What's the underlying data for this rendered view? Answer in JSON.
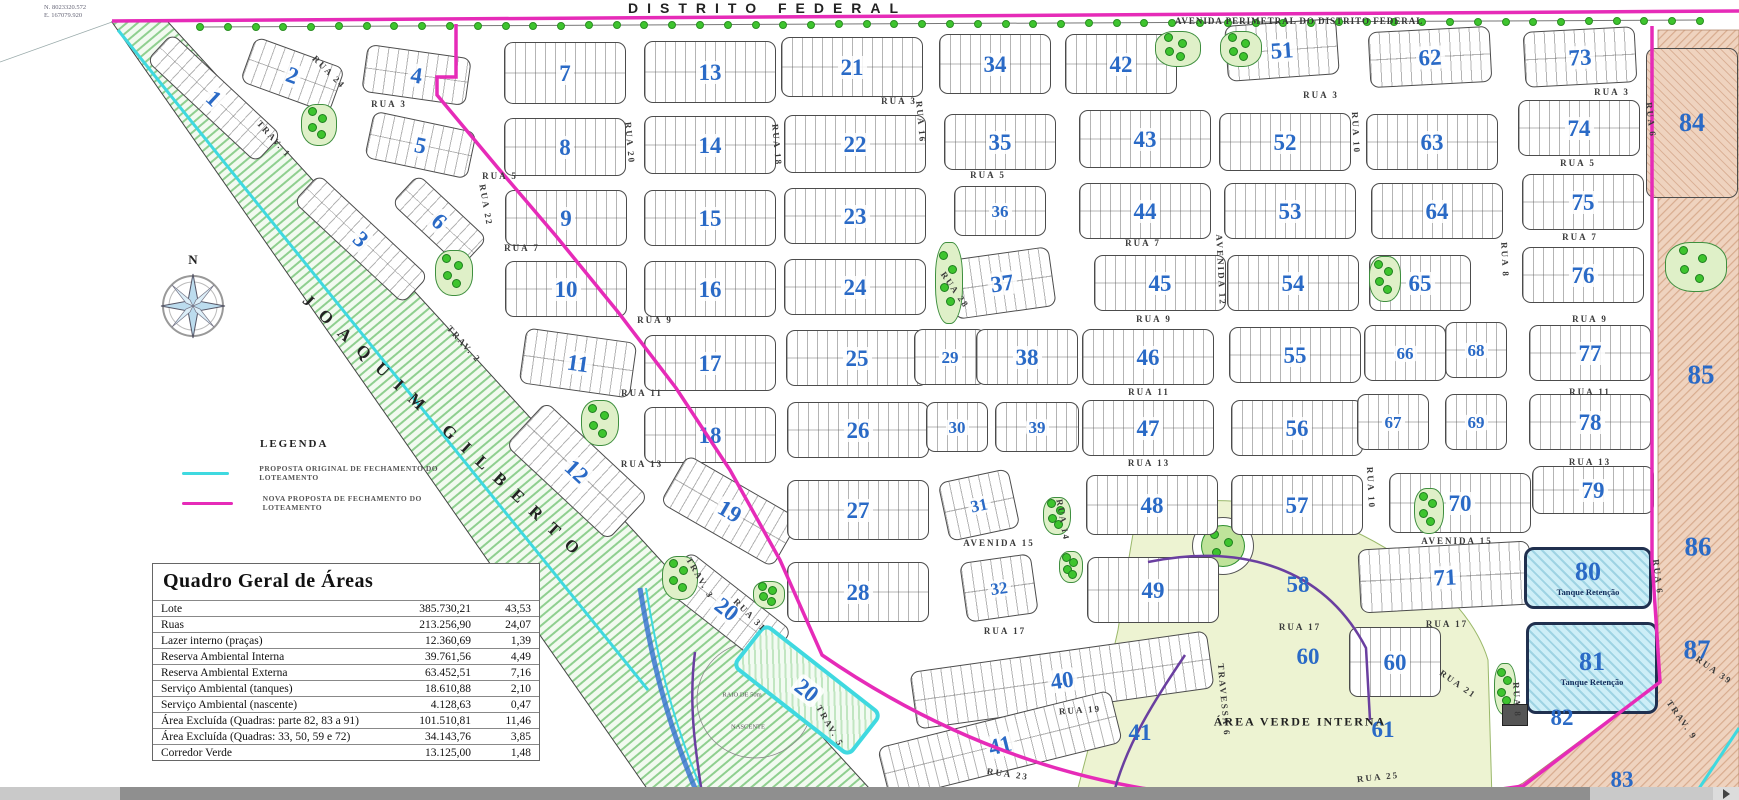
{
  "header": {
    "top_title": "DISTRITO FEDERAL",
    "avenida_perimetral": "AVENIDA PERIMETRAL DO DISTRITO FEDERAL",
    "diagonal_road": "JOAQUIM GILBERTO",
    "corner_coordinates": {
      "north": "N. 8023320.572",
      "east": "E. 167079.920"
    },
    "compass_label": "N"
  },
  "legend": {
    "title": "LEGENDA",
    "items": [
      {
        "color": "#3fd9e0",
        "label": "PROPOSTA ORIGINAL DE FECHAMENTO DO LOTEAMENTO"
      },
      {
        "color": "#e62bb8",
        "label": "NOVA PROPOSTA DE FECHAMENTO DO LOTEAMENTO"
      }
    ]
  },
  "areas_table": {
    "title": "Quadro Geral de Áreas",
    "rows": [
      {
        "label": "Lote",
        "area": "385.730,21",
        "pct": "43,53"
      },
      {
        "label": "Ruas",
        "area": "213.256,90",
        "pct": "24,07"
      },
      {
        "label": "Lazer interno (praças)",
        "area": "12.360,69",
        "pct": "1,39"
      },
      {
        "label": "Reserva Ambiental Interna",
        "area": "39.761,56",
        "pct": "4,49"
      },
      {
        "label": "Reserva Ambiental Externa",
        "area": "63.452,51",
        "pct": "7,16"
      },
      {
        "label": "Serviço Ambiental (tanques)",
        "area": "18.610,88",
        "pct": "2,10"
      },
      {
        "label": "Serviço Ambiental (nascente)",
        "area": "4.128,63",
        "pct": "0,47"
      },
      {
        "label": "Área Excluída (Quadras: parte 82, 83 a 91)",
        "area": "101.510,81",
        "pct": "11,46"
      },
      {
        "label": "Área Excluída (Quadras: 33, 50, 59 e 72)",
        "area": "34.143,76",
        "pct": "3,85"
      },
      {
        "label": "Corredor Verde",
        "area": "13.125,00",
        "pct": "1,48"
      }
    ]
  },
  "colors": {
    "original_proposal": "#3fd9e0",
    "new_proposal": "#e62bb8",
    "block_number_blue": "#2a6ac6",
    "tree_green": "#3ec42e",
    "excluded_pink": "#efd3bf",
    "tank_blue": "#cdeef7",
    "green_area": "#edf3d2",
    "corridor_purple": "#6a3fa0"
  },
  "map": {
    "tank_sublabel": "Tanque Retenção",
    "blocks": [
      {
        "n": "1",
        "x": 214,
        "y": 98,
        "w": 150,
        "h": 38,
        "rot": 43
      },
      {
        "n": "2",
        "x": 292,
        "y": 75,
        "w": 95,
        "h": 48,
        "rot": 20
      },
      {
        "n": "3",
        "x": 361,
        "y": 239,
        "w": 150,
        "h": 38,
        "rot": 43
      },
      {
        "n": "4",
        "x": 416,
        "y": 75,
        "w": 105,
        "h": 48,
        "rot": 8
      },
      {
        "n": "5",
        "x": 420,
        "y": 145,
        "w": 105,
        "h": 48,
        "rot": 12
      },
      {
        "n": "6",
        "x": 439,
        "y": 221,
        "w": 95,
        "h": 40,
        "rot": 43
      },
      {
        "n": "7",
        "x": 565,
        "y": 73,
        "w": 122,
        "h": 62,
        "rot": 0
      },
      {
        "n": "8",
        "x": 565,
        "y": 147,
        "w": 122,
        "h": 58,
        "rot": 0
      },
      {
        "n": "9",
        "x": 566,
        "y": 218,
        "w": 122,
        "h": 56,
        "rot": 0
      },
      {
        "n": "10",
        "x": 566,
        "y": 289,
        "w": 122,
        "h": 56,
        "rot": 0
      },
      {
        "n": "11",
        "x": 578,
        "y": 363,
        "w": 112,
        "h": 56,
        "rot": 8
      },
      {
        "n": "12",
        "x": 577,
        "y": 471,
        "w": 140,
        "h": 60,
        "rot": 43
      },
      {
        "n": "13",
        "x": 710,
        "y": 72,
        "w": 132,
        "h": 62,
        "rot": 0
      },
      {
        "n": "14",
        "x": 710,
        "y": 145,
        "w": 132,
        "h": 58,
        "rot": 0
      },
      {
        "n": "15",
        "x": 710,
        "y": 218,
        "w": 132,
        "h": 56,
        "rot": 0
      },
      {
        "n": "16",
        "x": 710,
        "y": 289,
        "w": 132,
        "h": 56,
        "rot": 0
      },
      {
        "n": "17",
        "x": 710,
        "y": 363,
        "w": 132,
        "h": 56,
        "rot": 0
      },
      {
        "n": "18",
        "x": 710,
        "y": 435,
        "w": 132,
        "h": 56,
        "rot": 0
      },
      {
        "n": "19",
        "x": 730,
        "y": 511,
        "w": 130,
        "h": 56,
        "rot": 30
      },
      {
        "n": "20",
        "x": 727,
        "y": 609,
        "w": 130,
        "h": 46,
        "rot": 38
      },
      {
        "n": "20",
        "x": 807,
        "y": 690,
        "w": 150,
        "h": 56,
        "rot": 38,
        "cls": "cyan"
      },
      {
        "n": "21",
        "x": 852,
        "y": 67,
        "w": 142,
        "h": 60,
        "rot": 0
      },
      {
        "n": "22",
        "x": 855,
        "y": 144,
        "w": 142,
        "h": 58,
        "rot": 0
      },
      {
        "n": "23",
        "x": 855,
        "y": 216,
        "w": 142,
        "h": 56,
        "rot": 0
      },
      {
        "n": "24",
        "x": 855,
        "y": 287,
        "w": 142,
        "h": 56,
        "rot": 0
      },
      {
        "n": "25",
        "x": 857,
        "y": 358,
        "w": 142,
        "h": 56,
        "rot": 0
      },
      {
        "n": "26",
        "x": 858,
        "y": 430,
        "w": 142,
        "h": 56,
        "rot": 0
      },
      {
        "n": "27",
        "x": 858,
        "y": 510,
        "w": 142,
        "h": 60,
        "rot": 0
      },
      {
        "n": "28",
        "x": 858,
        "y": 592,
        "w": 142,
        "h": 60,
        "rot": 0
      },
      {
        "n": "29",
        "x": 950,
        "y": 357,
        "w": 72,
        "h": 56,
        "rot": 0,
        "cls": "sm"
      },
      {
        "n": "30",
        "x": 957,
        "y": 427,
        "w": 62,
        "h": 50,
        "rot": 0,
        "cls": "sm"
      },
      {
        "n": "31",
        "x": 979,
        "y": 505,
        "w": 72,
        "h": 60,
        "rot": -12,
        "cls": "sm"
      },
      {
        "n": "32",
        "x": 999,
        "y": 588,
        "w": 72,
        "h": 60,
        "rot": -8,
        "cls": "sm"
      },
      {
        "n": "34",
        "x": 995,
        "y": 64,
        "w": 112,
        "h": 60,
        "rot": 0
      },
      {
        "n": "35",
        "x": 1000,
        "y": 142,
        "w": 112,
        "h": 56,
        "rot": 0
      },
      {
        "n": "36",
        "x": 1000,
        "y": 211,
        "w": 92,
        "h": 50,
        "rot": 0,
        "cls": "sm"
      },
      {
        "n": "37",
        "x": 1002,
        "y": 283,
        "w": 102,
        "h": 60,
        "rot": -8
      },
      {
        "n": "38",
        "x": 1027,
        "y": 357,
        "w": 102,
        "h": 56,
        "rot": 0
      },
      {
        "n": "39",
        "x": 1037,
        "y": 427,
        "w": 84,
        "h": 50,
        "rot": 0,
        "cls": "sm"
      },
      {
        "n": "40",
        "x": 1062,
        "y": 680,
        "w": 300,
        "h": 58,
        "rot": -8
      },
      {
        "n": "41",
        "x": 1000,
        "y": 745,
        "w": 240,
        "h": 54,
        "rot": -14
      },
      {
        "n": "42",
        "x": 1121,
        "y": 64,
        "w": 112,
        "h": 60,
        "rot": 0
      },
      {
        "n": "43",
        "x": 1145,
        "y": 139,
        "w": 132,
        "h": 58,
        "rot": 0
      },
      {
        "n": "44",
        "x": 1145,
        "y": 211,
        "w": 132,
        "h": 56,
        "rot": 0
      },
      {
        "n": "45",
        "x": 1160,
        "y": 283,
        "w": 132,
        "h": 56,
        "rot": 0
      },
      {
        "n": "46",
        "x": 1148,
        "y": 357,
        "w": 132,
        "h": 56,
        "rot": 0
      },
      {
        "n": "47",
        "x": 1148,
        "y": 428,
        "w": 132,
        "h": 56,
        "rot": 0
      },
      {
        "n": "48",
        "x": 1152,
        "y": 505,
        "w": 132,
        "h": 60,
        "rot": 0
      },
      {
        "n": "49",
        "x": 1153,
        "y": 590,
        "w": 132,
        "h": 66,
        "rot": 0
      },
      {
        "n": "51",
        "x": 1282,
        "y": 50,
        "w": 112,
        "h": 56,
        "rot": -4
      },
      {
        "n": "52",
        "x": 1285,
        "y": 142,
        "w": 132,
        "h": 58,
        "rot": 0
      },
      {
        "n": "53",
        "x": 1290,
        "y": 211,
        "w": 132,
        "h": 56,
        "rot": 0
      },
      {
        "n": "54",
        "x": 1293,
        "y": 283,
        "w": 132,
        "h": 56,
        "rot": 0
      },
      {
        "n": "55",
        "x": 1295,
        "y": 355,
        "w": 132,
        "h": 56,
        "rot": 0
      },
      {
        "n": "56",
        "x": 1297,
        "y": 428,
        "w": 132,
        "h": 56,
        "rot": 0
      },
      {
        "n": "57",
        "x": 1297,
        "y": 505,
        "w": 132,
        "h": 60,
        "rot": 0
      },
      {
        "n": "60",
        "x": 1395,
        "y": 662,
        "w": 92,
        "h": 70,
        "rot": 0
      },
      {
        "n": "62",
        "x": 1430,
        "y": 57,
        "w": 122,
        "h": 56,
        "rot": -3
      },
      {
        "n": "63",
        "x": 1432,
        "y": 142,
        "w": 132,
        "h": 56,
        "rot": 0
      },
      {
        "n": "64",
        "x": 1437,
        "y": 211,
        "w": 132,
        "h": 56,
        "rot": 0
      },
      {
        "n": "65",
        "x": 1420,
        "y": 283,
        "w": 102,
        "h": 56,
        "rot": 0
      },
      {
        "n": "66",
        "x": 1405,
        "y": 353,
        "w": 82,
        "h": 56,
        "rot": 0,
        "cls": "sm"
      },
      {
        "n": "67",
        "x": 1393,
        "y": 422,
        "w": 72,
        "h": 56,
        "rot": 0,
        "cls": "sm"
      },
      {
        "n": "68",
        "x": 1476,
        "y": 350,
        "w": 62,
        "h": 56,
        "rot": 0,
        "cls": "sm"
      },
      {
        "n": "69",
        "x": 1476,
        "y": 422,
        "w": 62,
        "h": 56,
        "rot": 0,
        "cls": "sm"
      },
      {
        "n": "70",
        "x": 1460,
        "y": 503,
        "w": 142,
        "h": 60,
        "rot": 0
      },
      {
        "n": "71",
        "x": 1445,
        "y": 577,
        "w": 172,
        "h": 64,
        "rot": -3
      },
      {
        "n": "73",
        "x": 1580,
        "y": 57,
        "w": 112,
        "h": 56,
        "rot": -3
      },
      {
        "n": "74",
        "x": 1579,
        "y": 128,
        "w": 122,
        "h": 56,
        "rot": 0
      },
      {
        "n": "75",
        "x": 1583,
        "y": 202,
        "w": 122,
        "h": 56,
        "rot": 0
      },
      {
        "n": "76",
        "x": 1583,
        "y": 275,
        "w": 122,
        "h": 56,
        "rot": 0
      },
      {
        "n": "77",
        "x": 1590,
        "y": 353,
        "w": 122,
        "h": 56,
        "rot": 0
      },
      {
        "n": "78",
        "x": 1590,
        "y": 422,
        "w": 122,
        "h": 56,
        "rot": 0
      },
      {
        "n": "79",
        "x": 1593,
        "y": 490,
        "w": 122,
        "h": 48,
        "rot": 0
      },
      {
        "n": "84",
        "x": 1692,
        "y": 123,
        "w": 92,
        "h": 150,
        "rot": 0,
        "cls": "pink"
      },
      {
        "n": "80",
        "x": 1588,
        "y": 578,
        "w": 128,
        "h": 62,
        "rot": 0,
        "cls": "tank",
        "sub": "Tanque Retenção"
      },
      {
        "n": "81",
        "x": 1592,
        "y": 668,
        "w": 132,
        "h": 92,
        "rot": 0,
        "cls": "tank",
        "sub": "Tanque Retenção"
      }
    ],
    "streets": [
      {
        "t": "RUA 3",
        "x": 389,
        "y": 104,
        "r": 0
      },
      {
        "t": "RUA 3",
        "x": 899,
        "y": 101,
        "r": 0
      },
      {
        "t": "RUA 3",
        "x": 1321,
        "y": 95,
        "r": 0
      },
      {
        "t": "RUA 3",
        "x": 1612,
        "y": 92,
        "r": 0
      },
      {
        "t": "RUA 5",
        "x": 500,
        "y": 176,
        "r": 0
      },
      {
        "t": "RUA 5",
        "x": 988,
        "y": 175,
        "r": 0
      },
      {
        "t": "RUA 5",
        "x": 1578,
        "y": 163,
        "r": 0
      },
      {
        "t": "RUA 7",
        "x": 522,
        "y": 248,
        "r": 0
      },
      {
        "t": "RUA 7",
        "x": 1143,
        "y": 243,
        "r": 0
      },
      {
        "t": "RUA 7",
        "x": 1580,
        "y": 237,
        "r": 0
      },
      {
        "t": "RUA 9",
        "x": 655,
        "y": 320,
        "r": 0
      },
      {
        "t": "RUA 9",
        "x": 1154,
        "y": 319,
        "r": 0
      },
      {
        "t": "RUA 9",
        "x": 1590,
        "y": 319,
        "r": 0
      },
      {
        "t": "RUA 11",
        "x": 642,
        "y": 393,
        "r": 0
      },
      {
        "t": "RUA 11",
        "x": 1149,
        "y": 392,
        "r": 0
      },
      {
        "t": "RUA 11",
        "x": 1590,
        "y": 392,
        "r": 0
      },
      {
        "t": "RUA 13",
        "x": 642,
        "y": 464,
        "r": 0
      },
      {
        "t": "RUA 13",
        "x": 1149,
        "y": 463,
        "r": 0
      },
      {
        "t": "RUA 13",
        "x": 1590,
        "y": 462,
        "r": 0
      },
      {
        "t": "AVENIDA 15",
        "x": 999,
        "y": 543,
        "r": 0
      },
      {
        "t": "AVENIDA 15",
        "x": 1457,
        "y": 541,
        "r": 0
      },
      {
        "t": "RUA 17",
        "x": 1005,
        "y": 631,
        "r": 0
      },
      {
        "t": "RUA 17",
        "x": 1300,
        "y": 627,
        "r": 0
      },
      {
        "t": "RUA 17",
        "x": 1447,
        "y": 624,
        "r": 0
      },
      {
        "t": "RUA 19",
        "x": 1080,
        "y": 710,
        "r": -4
      },
      {
        "t": "RUA 21",
        "x": 1458,
        "y": 684,
        "r": 35
      },
      {
        "t": "RUA 23",
        "x": 1008,
        "y": 774,
        "r": 8
      },
      {
        "t": "RUA 25",
        "x": 1378,
        "y": 777,
        "r": -6
      },
      {
        "t": "RUA 24",
        "x": 329,
        "y": 72,
        "r": 45
      },
      {
        "t": "RUA 22",
        "x": 486,
        "y": 205,
        "r": 80
      },
      {
        "t": "RUA 20",
        "x": 630,
        "y": 143,
        "r": 85
      },
      {
        "t": "RUA 18",
        "x": 777,
        "y": 145,
        "r": 85
      },
      {
        "t": "RUA 16",
        "x": 921,
        "y": 122,
        "r": 85
      },
      {
        "t": "RUA 28",
        "x": 955,
        "y": 290,
        "r": 55
      },
      {
        "t": "RUA 14",
        "x": 1063,
        "y": 520,
        "r": 80
      },
      {
        "t": "AVENIDA 12",
        "x": 1221,
        "y": 270,
        "r": 87
      },
      {
        "t": "RUA 10",
        "x": 1356,
        "y": 133,
        "r": 87
      },
      {
        "t": "RUA 10",
        "x": 1371,
        "y": 488,
        "r": 87
      },
      {
        "t": "RUA 8",
        "x": 1505,
        "y": 260,
        "r": 87
      },
      {
        "t": "RUA 8",
        "x": 1517,
        "y": 700,
        "r": 87
      },
      {
        "t": "RUA 6",
        "x": 1651,
        "y": 120,
        "r": 83
      },
      {
        "t": "RUA 6",
        "x": 1658,
        "y": 577,
        "r": 83
      },
      {
        "t": "RUA 39",
        "x": 1714,
        "y": 670,
        "r": 35
      },
      {
        "t": "TRAV. 9",
        "x": 1682,
        "y": 720,
        "r": 55
      },
      {
        "t": "TRAVESSA 6",
        "x": 1224,
        "y": 700,
        "r": 85
      },
      {
        "t": "TRAV. 1",
        "x": 274,
        "y": 139,
        "r": 48
      },
      {
        "t": "TRAV. 2",
        "x": 464,
        "y": 344,
        "r": 48
      },
      {
        "t": "TRAV. 3",
        "x": 700,
        "y": 578,
        "r": 60
      },
      {
        "t": "TRAV. 5",
        "x": 830,
        "y": 726,
        "r": 60
      },
      {
        "t": "RUA 31",
        "x": 750,
        "y": 615,
        "r": 45
      }
    ],
    "area_labels": [
      {
        "t": "58",
        "x": 1298,
        "y": 585,
        "cls": "num"
      },
      {
        "t": "60",
        "x": 1308,
        "y": 657,
        "cls": "num"
      },
      {
        "t": "61",
        "x": 1383,
        "y": 730,
        "cls": "num"
      },
      {
        "t": "41",
        "x": 1140,
        "y": 733,
        "cls": "num"
      },
      {
        "t": "82",
        "x": 1562,
        "y": 718,
        "cls": "num"
      },
      {
        "t": "83",
        "x": 1622,
        "y": 780,
        "cls": "num"
      },
      {
        "t": "85",
        "x": 1701,
        "y": 375,
        "cls": "bignum"
      },
      {
        "t": "86",
        "x": 1698,
        "y": 547,
        "cls": "bignum"
      },
      {
        "t": "87",
        "x": 1697,
        "y": 650,
        "cls": "bignum"
      },
      {
        "t": "ÁREA VERDE INTERNA",
        "x": 1300,
        "y": 722,
        "cls": "caption"
      },
      {
        "t": "NASCENTE",
        "x": 748,
        "y": 727,
        "cls": "tiny"
      },
      {
        "t": "RAIO DE 50m",
        "x": 742,
        "y": 695,
        "cls": "tiny"
      }
    ],
    "pracas": [
      [
        318,
        124,
        34,
        40
      ],
      [
        453,
        272,
        36,
        44
      ],
      [
        599,
        422,
        36,
        44
      ],
      [
        679,
        577,
        34,
        42
      ],
      [
        768,
        594,
        30,
        26
      ],
      [
        948,
        282,
        26,
        80
      ],
      [
        1056,
        515,
        26,
        36
      ],
      [
        1070,
        566,
        22,
        30
      ],
      [
        1177,
        48,
        44,
        34
      ],
      [
        1240,
        48,
        40,
        34
      ],
      [
        1384,
        278,
        30,
        44
      ],
      [
        1428,
        510,
        28,
        44
      ],
      [
        1695,
        266,
        60,
        48
      ],
      [
        1504,
        688,
        20,
        50
      ]
    ],
    "tree_row": {
      "y": 27,
      "x0": 200,
      "x1": 1700,
      "count": 55
    }
  }
}
